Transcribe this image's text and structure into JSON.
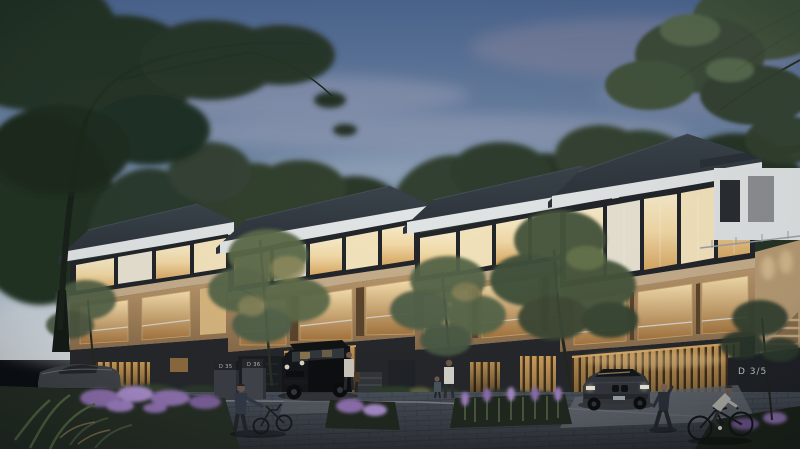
{
  "scene": {
    "title": "Modern three-storey townhouse complex at dusk, architectural render with warm interior lighting, trees, paved street, parked cars, pedestrians and cyclists",
    "time_of_day": "dusk",
    "style": "photorealistic architectural 3D render",
    "counts": {
      "townhouses": 4,
      "cars": 3,
      "people": 5,
      "bicycles": 2
    }
  },
  "signs": {
    "unit_plaque_right": "D 3/5",
    "meter_box_left": "D 35",
    "meter_box_right": "D 36"
  },
  "palette": {
    "sky_top": "#4c6690",
    "sky_horizon": "#d3d9dd",
    "cloud_pink": "#bfb3c6",
    "roof": "#2b3138",
    "fascia": "#e2e5e5",
    "stone": "#c6ae8c",
    "wood": "#a8895f",
    "glow": "#f2d9a6",
    "base": "#26282b",
    "road": "#3b4046",
    "purple": "#8e6fae",
    "foliage_dark": "#2a362c",
    "foliage_light": "#55684b"
  }
}
